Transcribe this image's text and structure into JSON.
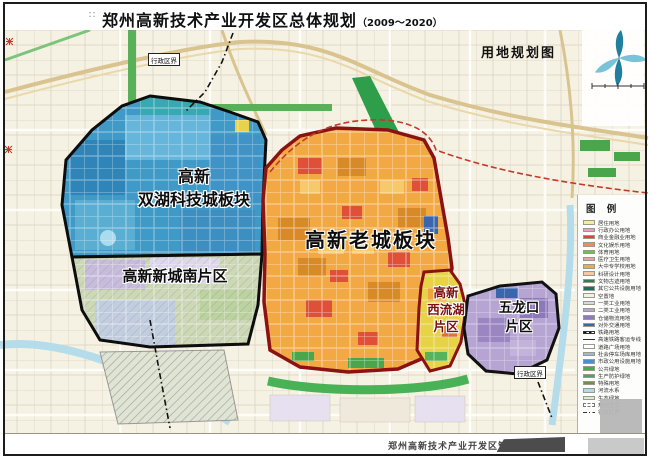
{
  "header": {
    "mark": "∷",
    "title": "郑州高新技术产业开发区总体规划",
    "title_suffix": "（2009～2020）",
    "subtitle": "用地规划图"
  },
  "map": {
    "regions": {
      "shuanghu": {
        "line1": "高新",
        "line2": "双湖科技城板块"
      },
      "xinchengnan": {
        "label": "高新新城南片区"
      },
      "laocheng": {
        "label": "高新老城板块"
      },
      "xiliuhu": {
        "line1": "高新",
        "line2": "西流湖",
        "line3": "片区"
      },
      "wulongkou": {
        "line1": "五龙口",
        "line2": "片区"
      }
    },
    "boundary_label": "行政区界",
    "region_colors": {
      "shuanghu": "#3f9ac8",
      "xinchengnan": "#ccd8b6",
      "laocheng": "#f2a943",
      "xiliuhu": "#e6d348",
      "wulongkou": "#b6a4d2"
    }
  },
  "legend": {
    "title": "图 例",
    "items": [
      {
        "label": "居住用地",
        "color": "#f6ec9f",
        "type": "fill"
      },
      {
        "label": "行政办公用地",
        "color": "#e79cc4",
        "type": "fill"
      },
      {
        "label": "商业金融业用地",
        "color": "#e0413a",
        "type": "fill"
      },
      {
        "label": "文化娱乐用地",
        "color": "#f08a5e",
        "type": "fill"
      },
      {
        "label": "体育用地",
        "color": "#6cc24f",
        "type": "fill"
      },
      {
        "label": "医疗卫生用地",
        "color": "#f0a0a8",
        "type": "fill"
      },
      {
        "label": "大中专学校用地",
        "color": "#f2a94e",
        "type": "fill"
      },
      {
        "label": "科研设计用地",
        "color": "#f8c9a0",
        "type": "fill"
      },
      {
        "label": "文物古迹用地",
        "color": "#2f7d56",
        "type": "fill"
      },
      {
        "label": "其它公共设施用地",
        "color": "#1f6e5e",
        "type": "fill"
      },
      {
        "label": "空置地",
        "color": "#f4f1e4",
        "type": "fill"
      },
      {
        "label": "一类工业用地",
        "color": "#dad6e9",
        "type": "fill"
      },
      {
        "label": "二类工业用地",
        "color": "#b9a6d0",
        "type": "fill"
      },
      {
        "label": "仓储物流用地",
        "color": "#8f7bb8",
        "type": "fill"
      },
      {
        "label": "对外交通用地",
        "color": "#3a66ae",
        "type": "fill"
      },
      {
        "label": "铁路用地",
        "color": "#222222",
        "type": "track"
      },
      {
        "label": "高速铁路客运专线",
        "color": "#333333",
        "type": "line"
      },
      {
        "label": "道路广场用地",
        "color": "#ffffff",
        "type": "fill"
      },
      {
        "label": "社会停车场库用地",
        "color": "#9fb8d8",
        "type": "fill"
      },
      {
        "label": "市政公用设施用地",
        "color": "#4a90d0",
        "type": "fill"
      },
      {
        "label": "公共绿地",
        "color": "#3cb04e",
        "type": "fill"
      },
      {
        "label": "生产防护绿地",
        "color": "#4da06a",
        "type": "fill"
      },
      {
        "label": "特殊用地",
        "color": "#7a8c4a",
        "type": "fill"
      },
      {
        "label": "河流水系",
        "color": "#aadcee",
        "type": "fill"
      },
      {
        "label": "生态绿地",
        "color": "#d6ecd2",
        "type": "fill"
      },
      {
        "label": "规划立交",
        "color": "#888888",
        "type": "dash"
      },
      {
        "label": "行政区界",
        "color": "#333333",
        "type": "dashdot"
      }
    ]
  },
  "footer": {
    "credit": "郑州高新技术产业开发区管理委"
  }
}
